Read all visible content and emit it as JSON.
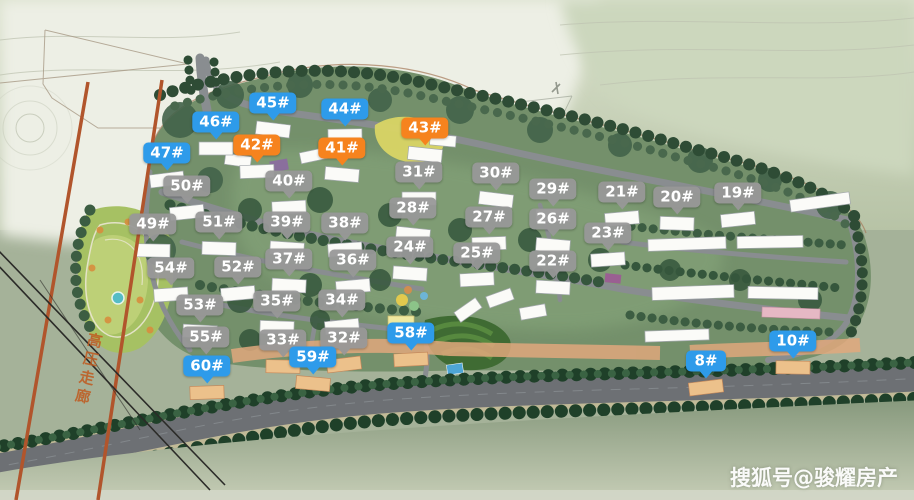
{
  "watermark": {
    "text": "搜狐号@骏耀房产"
  },
  "annotations": {
    "corridor_label": "高压走廊"
  },
  "marker_colors": {
    "blue": "#2e9bea",
    "orange": "#f6831e",
    "gray": "rgba(152,152,152,0.95)"
  },
  "markers": [
    {
      "label": "8#",
      "color": "blue",
      "x": 706,
      "y": 361
    },
    {
      "label": "10#",
      "color": "blue",
      "x": 793,
      "y": 341
    },
    {
      "label": "19#",
      "color": "gray",
      "x": 738,
      "y": 193
    },
    {
      "label": "20#",
      "color": "gray",
      "x": 677,
      "y": 197
    },
    {
      "label": "21#",
      "color": "gray",
      "x": 622,
      "y": 192
    },
    {
      "label": "22#",
      "color": "gray",
      "x": 553,
      "y": 261
    },
    {
      "label": "23#",
      "color": "gray",
      "x": 608,
      "y": 233
    },
    {
      "label": "24#",
      "color": "gray",
      "x": 410,
      "y": 247
    },
    {
      "label": "25#",
      "color": "gray",
      "x": 477,
      "y": 253
    },
    {
      "label": "26#",
      "color": "gray",
      "x": 553,
      "y": 219
    },
    {
      "label": "27#",
      "color": "gray",
      "x": 489,
      "y": 217
    },
    {
      "label": "28#",
      "color": "gray",
      "x": 413,
      "y": 208
    },
    {
      "label": "29#",
      "color": "gray",
      "x": 553,
      "y": 189
    },
    {
      "label": "30#",
      "color": "gray",
      "x": 496,
      "y": 173
    },
    {
      "label": "31#",
      "color": "gray",
      "x": 419,
      "y": 172
    },
    {
      "label": "32#",
      "color": "gray",
      "x": 344,
      "y": 338
    },
    {
      "label": "33#",
      "color": "gray",
      "x": 283,
      "y": 340
    },
    {
      "label": "34#",
      "color": "gray",
      "x": 342,
      "y": 300
    },
    {
      "label": "35#",
      "color": "gray",
      "x": 277,
      "y": 301
    },
    {
      "label": "36#",
      "color": "gray",
      "x": 353,
      "y": 260
    },
    {
      "label": "37#",
      "color": "gray",
      "x": 289,
      "y": 259
    },
    {
      "label": "38#",
      "color": "gray",
      "x": 345,
      "y": 223
    },
    {
      "label": "39#",
      "color": "gray",
      "x": 287,
      "y": 222
    },
    {
      "label": "40#",
      "color": "gray",
      "x": 289,
      "y": 181
    },
    {
      "label": "41#",
      "color": "orange",
      "x": 342,
      "y": 148
    },
    {
      "label": "42#",
      "color": "orange",
      "x": 257,
      "y": 145
    },
    {
      "label": "43#",
      "color": "orange",
      "x": 425,
      "y": 128
    },
    {
      "label": "44#",
      "color": "blue",
      "x": 345,
      "y": 109
    },
    {
      "label": "45#",
      "color": "blue",
      "x": 273,
      "y": 103
    },
    {
      "label": "46#",
      "color": "blue",
      "x": 216,
      "y": 122
    },
    {
      "label": "47#",
      "color": "blue",
      "x": 167,
      "y": 153
    },
    {
      "label": "49#",
      "color": "gray",
      "x": 153,
      "y": 224
    },
    {
      "label": "50#",
      "color": "gray",
      "x": 187,
      "y": 186
    },
    {
      "label": "51#",
      "color": "gray",
      "x": 219,
      "y": 222
    },
    {
      "label": "52#",
      "color": "gray",
      "x": 238,
      "y": 267
    },
    {
      "label": "53#",
      "color": "gray",
      "x": 200,
      "y": 305
    },
    {
      "label": "54#",
      "color": "gray",
      "x": 171,
      "y": 268
    },
    {
      "label": "55#",
      "color": "gray",
      "x": 206,
      "y": 337
    },
    {
      "label": "58#",
      "color": "blue",
      "x": 411,
      "y": 333
    },
    {
      "label": "59#",
      "color": "blue",
      "x": 313,
      "y": 357
    },
    {
      "label": "60#",
      "color": "blue",
      "x": 207,
      "y": 366
    }
  ]
}
